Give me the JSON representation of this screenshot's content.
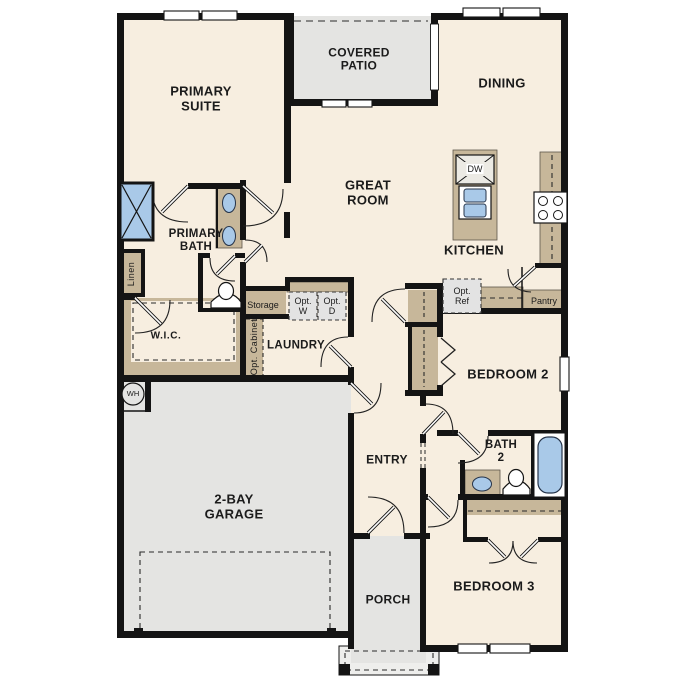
{
  "plan": {
    "type": "single-story residential floor plan",
    "rooms": {
      "primary_suite": "PRIMARY SUITE",
      "covered_patio": "COVERED PATIO",
      "dining": "DINING",
      "great_room": "GREAT ROOM",
      "kitchen": "KITCHEN",
      "primary_bath": "PRIMARY BATH",
      "wic": "W.I.C.",
      "laundry": "LAUNDRY",
      "entry": "ENTRY",
      "garage": "2-BAY GARAGE",
      "porch": "PORCH",
      "bedroom2": "BEDROOM 2",
      "bath2": "BATH 2",
      "bedroom3": "BEDROOM 3"
    },
    "features": {
      "linen": "Linen",
      "storage": "Storage",
      "opt_cabinet": "Opt. Cabinet",
      "opt_washer": "Opt. W",
      "opt_dryer": "Opt. D",
      "opt_refrigerator": "Opt. Ref",
      "pantry": "Pantry"
    },
    "appliances": {
      "dishwasher": "DW",
      "water_heater": "WH"
    },
    "colors": {
      "floor": "#f7eee0",
      "outdoor_concrete": "#e4e4e2",
      "cabinetry": "#c7b79a",
      "fixture_blue": "#a9c9e8",
      "wall": "#141414",
      "optional_item_fill": "#e3e3e3"
    }
  }
}
